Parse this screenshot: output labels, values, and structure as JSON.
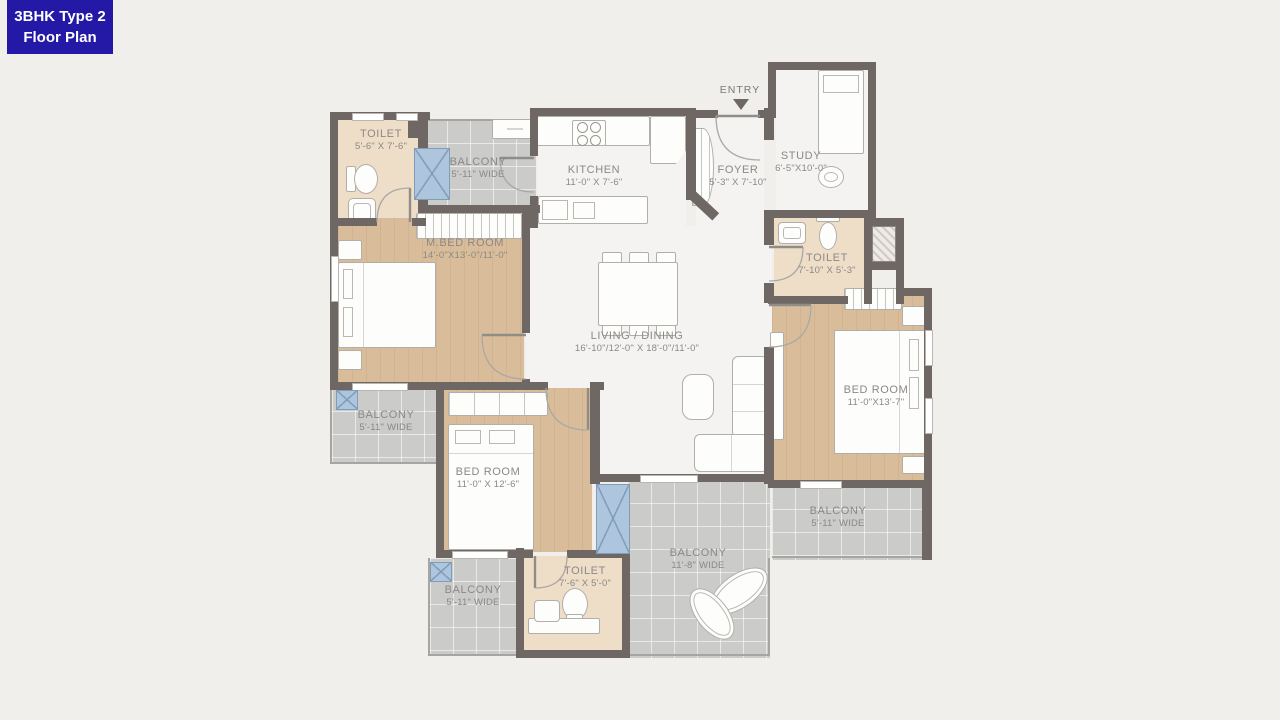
{
  "title_badge": {
    "line1": "3BHK Type 2",
    "line2": "Floor Plan"
  },
  "entry_label": "ENTRY",
  "rooms": {
    "toilet_top_left": {
      "name": "TOILET",
      "dims": "5'-6\" X 7'-6\""
    },
    "balcony_top": {
      "name": "BALCONY",
      "dims": "5'-11\" WIDE"
    },
    "kitchen": {
      "name": "KITCHEN",
      "dims": "11'-0\" X 7'-6\""
    },
    "foyer": {
      "name": "FOYER",
      "dims": "5'-3\" X 7'-10\""
    },
    "study": {
      "name": "STUDY",
      "dims": "6'-5\"X10'-0\""
    },
    "master_bedroom": {
      "name": "M.BED ROOM",
      "dims": "14'-0\"X13'-0\"/11'-0\""
    },
    "living_dining": {
      "name": "LIVING / DINING",
      "dims": "16'-10\"/12'-0\" X 18'-0\"/11'-0\""
    },
    "toilet_right": {
      "name": "TOILET",
      "dims": "7'-10\" X 5'-3\""
    },
    "bedroom_right": {
      "name": "BED ROOM",
      "dims": "11'-0\"X13'-7\""
    },
    "balcony_left": {
      "name": "BALCONY",
      "dims": "5'-11\" WIDE"
    },
    "bedroom_bottom": {
      "name": "BED ROOM",
      "dims": "11'-0\" X 12'-6\""
    },
    "balcony_bottom_center": {
      "name": "BALCONY",
      "dims": "11'-8\" WIDE"
    },
    "balcony_bottom_right": {
      "name": "BALCONY",
      "dims": "5'-11\" WIDE"
    },
    "balcony_bottom_left": {
      "name": "BALCONY",
      "dims": "5'-11\" WIDE"
    },
    "toilet_bottom": {
      "name": "TOILET",
      "dims": "7'-6\" X 5'-0\""
    }
  },
  "colors": {
    "badge_bg": "#2319a6",
    "badge_text": "#ffffff",
    "wall": "#6f6764",
    "wood_floor": "#d9bd9a",
    "tile_floor": "#cbcbca",
    "toilet_floor": "#eedec8",
    "marble_floor": "#f4f3f1",
    "window_blue": "#adc6de",
    "label_text": "#8b8885",
    "page_bg": "#f1efec"
  }
}
